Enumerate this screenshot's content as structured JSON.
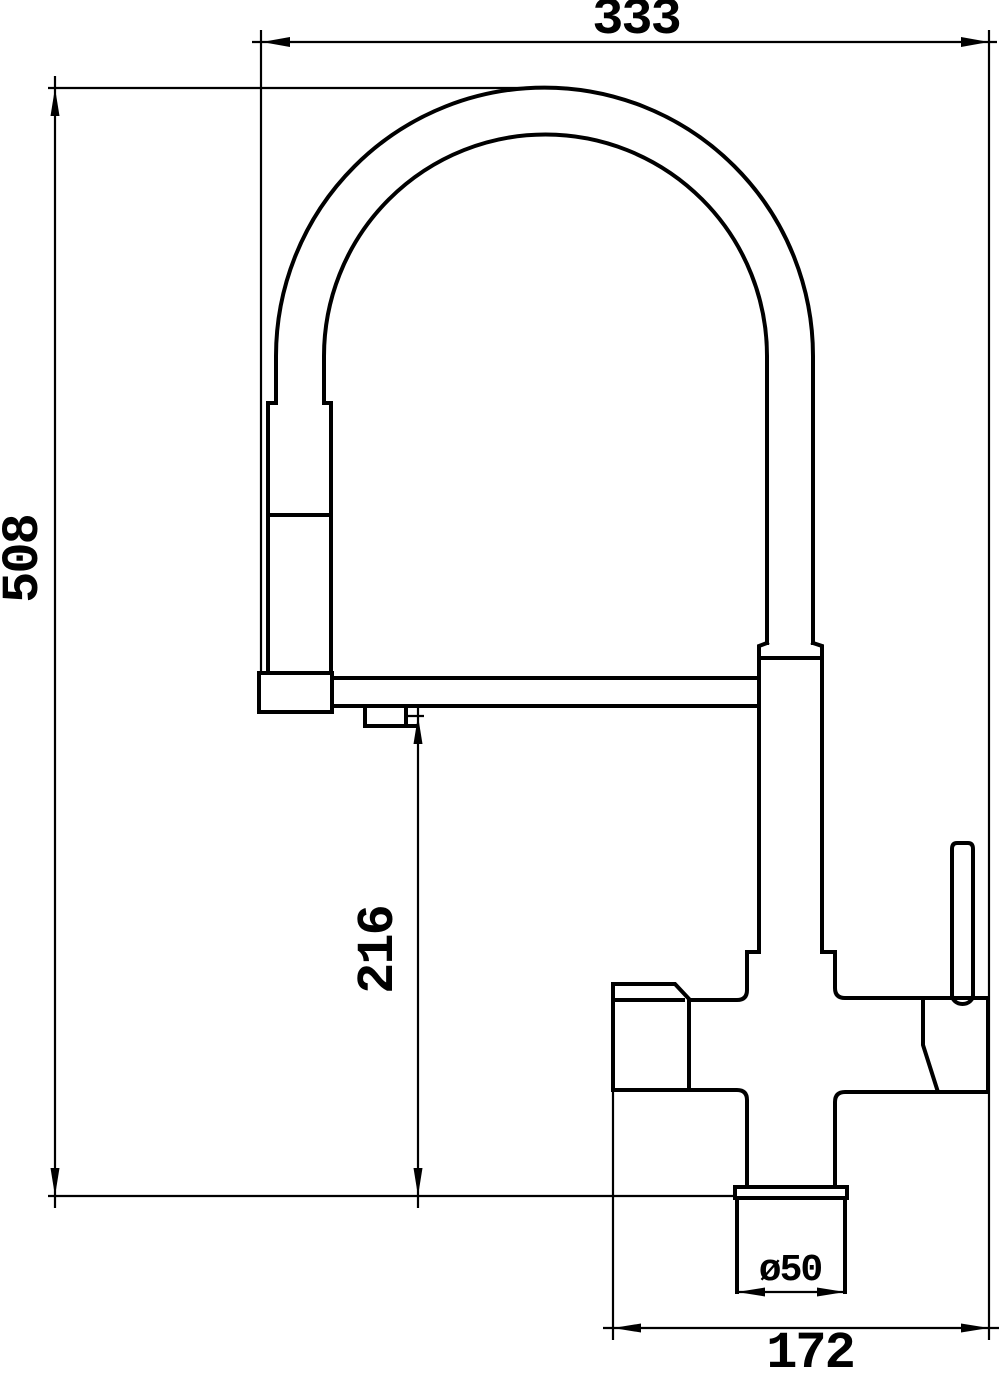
{
  "page": {
    "background_color": "#ffffff",
    "line_color": "#000000"
  },
  "drawing": {
    "kind": "faucet-technical-drawing",
    "dimensions": {
      "overall_width": {
        "label": "333"
      },
      "overall_height": {
        "label": "508"
      },
      "outlet_height": {
        "label": "216"
      },
      "base_diameter": {
        "label": "ø50"
      },
      "footprint_width": {
        "label": "172"
      }
    }
  }
}
